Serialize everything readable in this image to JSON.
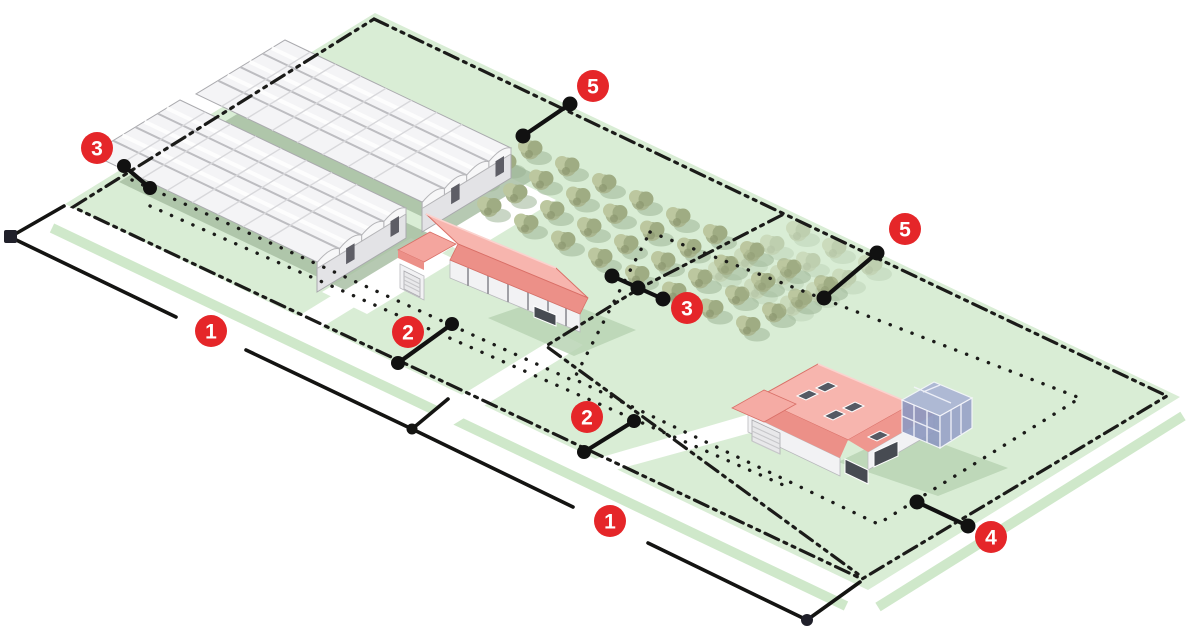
{
  "markers": [
    {
      "name": "marker-3-left",
      "label": "3"
    },
    {
      "name": "marker-5-top",
      "label": "5"
    },
    {
      "name": "marker-5-right",
      "label": "5"
    },
    {
      "name": "marker-1-upper",
      "label": "1"
    },
    {
      "name": "marker-2-left",
      "label": "2"
    },
    {
      "name": "marker-3-middle",
      "label": "3"
    },
    {
      "name": "marker-2-middle",
      "label": "2"
    },
    {
      "name": "marker-1-lower",
      "label": "1"
    },
    {
      "name": "marker-4-right",
      "label": "4"
    }
  ],
  "colors": {
    "badge_red": "#e52629",
    "land_green": "#d9edd5",
    "verge_green": "#cfe8ca",
    "shadow_green": "#b9d3b4",
    "greenhouse_shadow": "#a4bb9f",
    "canopy_green": "#aab690",
    "canopy_light": "#bcc79f",
    "canopy_dark": "#9fac83",
    "ghost_green": "#b0bcae",
    "roof_salmon": "#f7b5ae",
    "roof_salmon_dark": "#ec9088",
    "glass_blue": "#8f9ac1",
    "line_black": "#1b1b19"
  },
  "features": [
    "greenhouses",
    "orchard",
    "farmhouse",
    "residence-with-conservatory",
    "property-boundary",
    "setback-lines",
    "road-lines"
  ]
}
